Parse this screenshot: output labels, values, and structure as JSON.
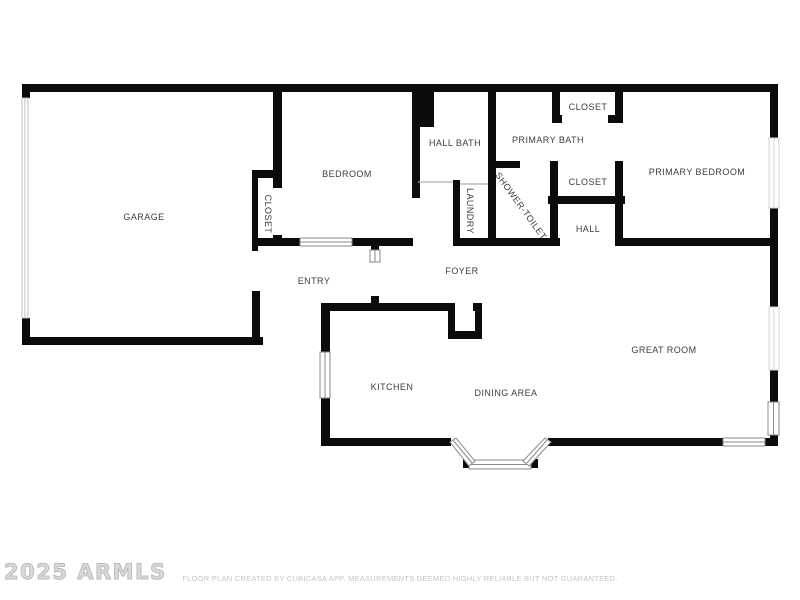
{
  "floorplan": {
    "rooms": [
      {
        "id": "garage",
        "label": "GARAGE"
      },
      {
        "id": "garage-closet",
        "label": "CLOSET"
      },
      {
        "id": "bedroom",
        "label": "BEDROOM"
      },
      {
        "id": "hall-bath",
        "label": "HALL BATH"
      },
      {
        "id": "primary-bath",
        "label": "PRIMARY BATH"
      },
      {
        "id": "closet-top",
        "label": "CLOSET"
      },
      {
        "id": "primary-bedroom",
        "label": "PRIMARY BEDROOM"
      },
      {
        "id": "closet-mid",
        "label": "CLOSET"
      },
      {
        "id": "shower-toilet",
        "label": "SHOWER-TOILET"
      },
      {
        "id": "laundry",
        "label": "LAUNDRY"
      },
      {
        "id": "hall",
        "label": "HALL"
      },
      {
        "id": "entry",
        "label": "ENTRY"
      },
      {
        "id": "foyer",
        "label": "FOYER"
      },
      {
        "id": "kitchen",
        "label": "KITCHEN"
      },
      {
        "id": "dining-area",
        "label": "DINING AREA"
      },
      {
        "id": "great-room",
        "label": "GREAT ROOM"
      }
    ],
    "watermark": "2025 ARMLS",
    "disclaimer": "FLOOR PLAN CREATED BY CUBICASA APP. MEASUREMENTS DEEMED HIGHLY RELIABLE BUT NOT GUARANTEED.",
    "colors": {
      "wall": "#0b0b0b",
      "label_text": "#3d3d3d",
      "window_stroke": "#8a8a8a",
      "watermark_gray": "#c2c2c2",
      "disclaimer_gray": "#c5c5c5",
      "background": "#ffffff"
    }
  }
}
